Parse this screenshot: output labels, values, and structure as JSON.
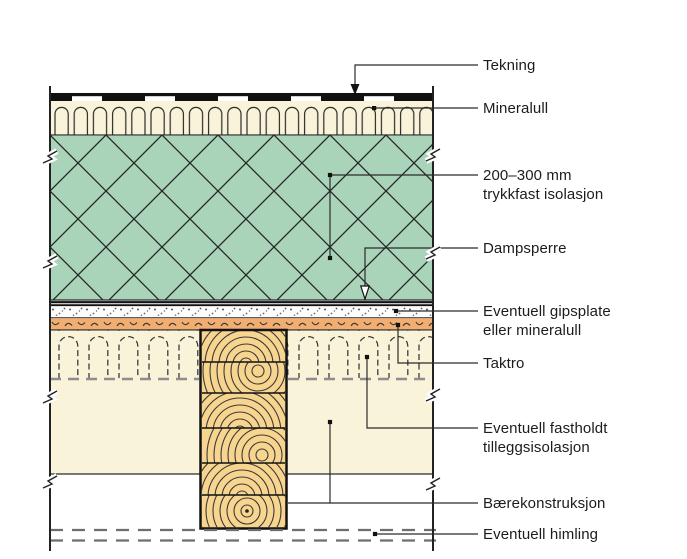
{
  "diagram": {
    "kind": "roof-construction-detail",
    "labels": [
      {
        "id": "tekning",
        "text": "Tekning"
      },
      {
        "id": "mineralull",
        "text": "Mineralull"
      },
      {
        "id": "trykkfast-isolasjon",
        "text": "200–300 mm\ntrykkfast isolasjon"
      },
      {
        "id": "dampsperre",
        "text": "Dampsperre"
      },
      {
        "id": "gipsplate",
        "text": "Eventuell gipsplate\neller mineralull"
      },
      {
        "id": "taktro",
        "text": "Taktro"
      },
      {
        "id": "tilleggsisolasjon",
        "text": "Eventuell fastholdt\ntilleggsisolasjon"
      },
      {
        "id": "baerekonstruksjon",
        "text": "Bærekonstruksjon"
      },
      {
        "id": "himling",
        "text": "Eventuell himling"
      }
    ],
    "colors": {
      "insulation_green": "#a9d4ba",
      "mineral_wool_cream": "#f9f3da",
      "taktro_orange": "#f1ae70",
      "wood_beam": "#f8d58f",
      "line": "#2a2a2a",
      "dash_gray": "#8d8d8d"
    }
  }
}
